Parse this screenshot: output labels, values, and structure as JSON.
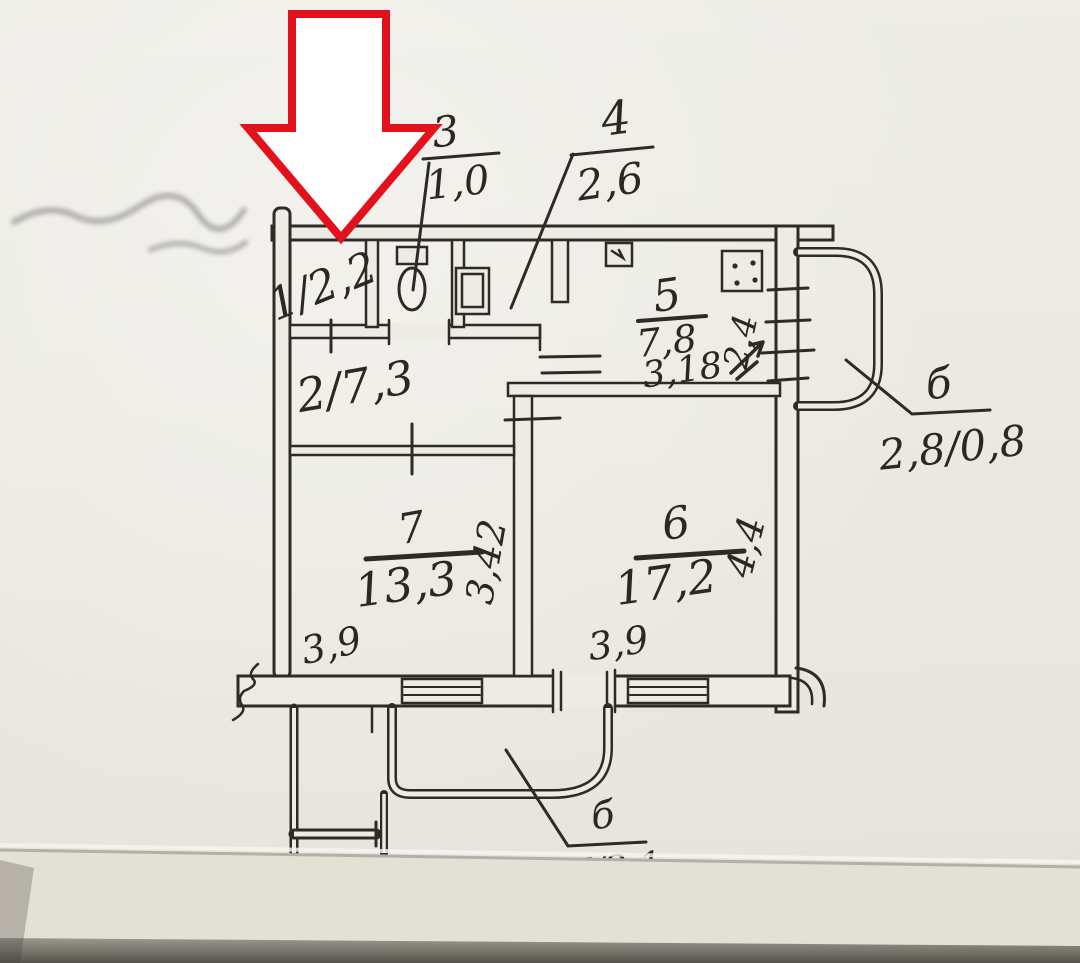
{
  "document": {
    "kind": "hand-drawn apartment floor plan (scanned paper sketch)",
    "marker": "large red outlined arrow pointing down at room 1"
  },
  "colors": {
    "paper": "#edebe4",
    "ink": "#2e2b26",
    "arrow_red": "#e2111b"
  },
  "rooms": {
    "r1": {
      "label": "1/2,2"
    },
    "r2": {
      "label": "2/7,3"
    },
    "r3": {
      "number": "3",
      "area": "1,0"
    },
    "r4": {
      "number": "4",
      "area": "2,6"
    },
    "r5": {
      "number": "5",
      "area": "7,8"
    },
    "r6": {
      "number": "6",
      "area": "17,2"
    },
    "r7": {
      "number": "7",
      "area": "13,3"
    }
  },
  "dimensions": {
    "kitchen_width": "3,18",
    "kitchen_depth": "2,4",
    "room7_width": "3,9",
    "room7_depth": "3,42",
    "room6_width": "3,9",
    "room6_depth": "4,4"
  },
  "balconies": {
    "top": {
      "label": "б",
      "size": "2,8/0,8"
    },
    "bottom": {
      "label": "б",
      "size": "17/2,1"
    }
  }
}
